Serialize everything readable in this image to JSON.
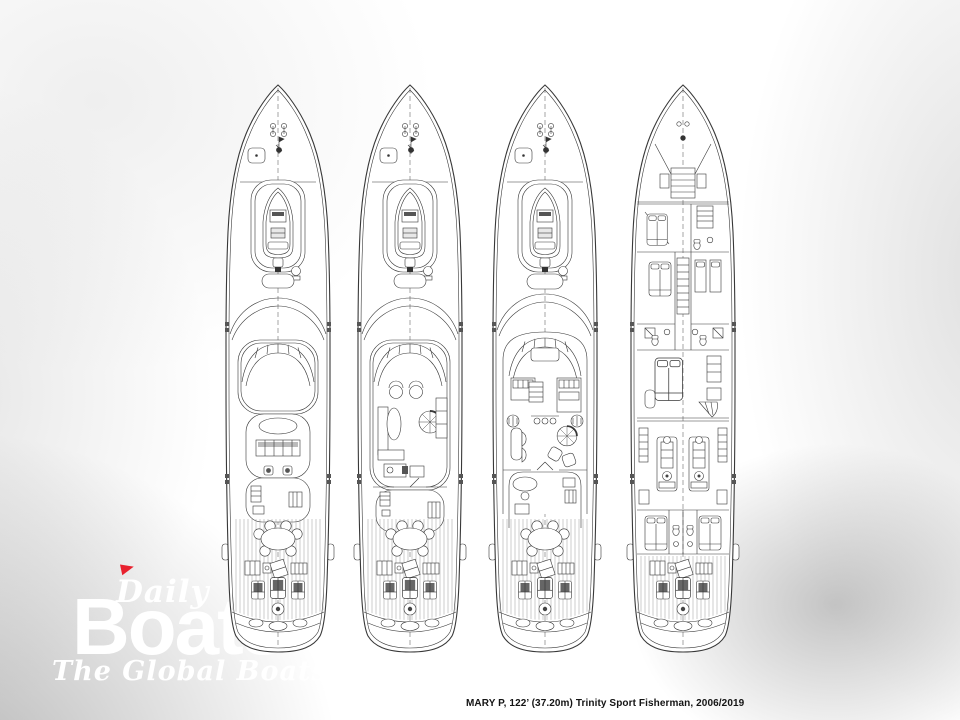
{
  "caption": {
    "text": "MARY P, 122’ (37.20m) Trinity Sport Fisherman, 2006/2019"
  },
  "watermark": {
    "brand_top": "Daily",
    "brand_main": "Boats",
    "tagline": "The Global Boats",
    "flag_color": "#e8212e",
    "text_color": "#ffffff"
  },
  "drawing": {
    "line_color": "#383838",
    "teak_line_color": "#9a9a9a",
    "decks": [
      {
        "id": "deck-plan-hardtop"
      },
      {
        "id": "deck-plan-flybridge"
      },
      {
        "id": "deck-plan-main"
      },
      {
        "id": "deck-plan-lower"
      }
    ]
  }
}
